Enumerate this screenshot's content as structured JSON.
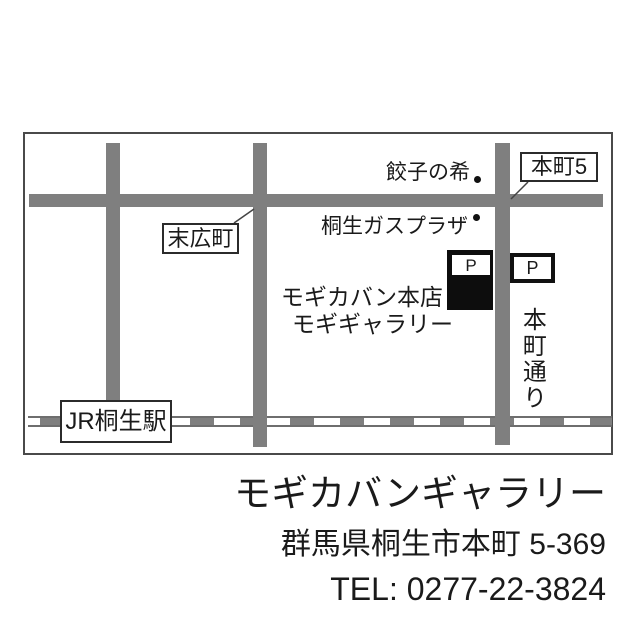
{
  "map": {
    "labels": {
      "honcho5": "本町5",
      "suehirocho": "末広町",
      "jr_station": "JR桐生駅",
      "gyoza": "餃子の希",
      "gas_plaza": "桐生ガスプラザ",
      "shop_line1": "モギカバン本店",
      "shop_line2": "モギギャラリー",
      "street": "本町通り",
      "parking_left": "P",
      "parking_right": "P"
    },
    "colors": {
      "road_gray": "#7f7f7f",
      "building_black": "#0d0d0d",
      "border_gray": "#4a4a4a",
      "text_black": "#1a1a1a"
    }
  },
  "info": {
    "title": "モギカバンギャラリー",
    "address": "群馬県桐生市本町 5-369",
    "tel": "TEL: 0277-22-3824"
  }
}
